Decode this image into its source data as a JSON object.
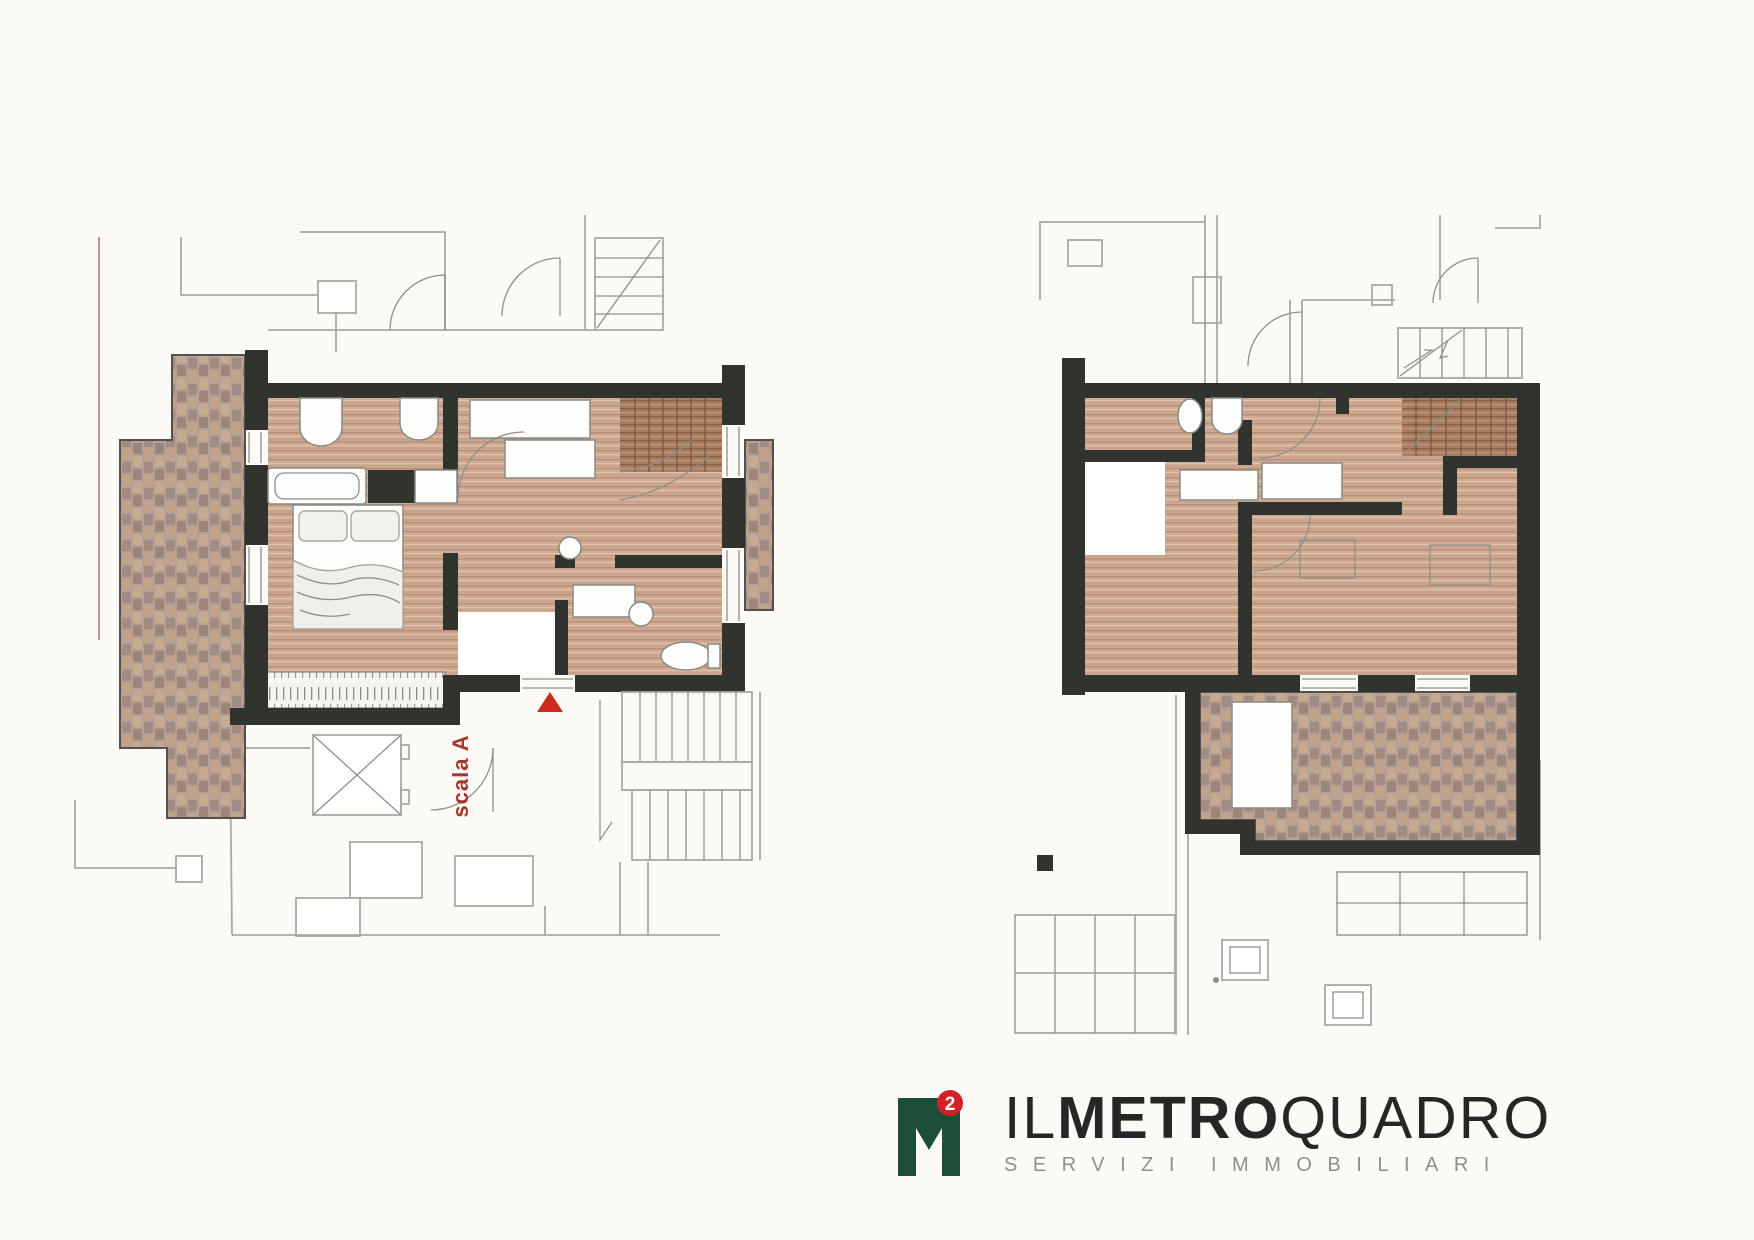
{
  "document": {
    "type": "floor-plan-sheet",
    "background": "#fbfaf6"
  },
  "palette": {
    "wall": "#30332e",
    "wood_light": "#cfab93",
    "wood_dark": "#a97f63",
    "herringbone_base": "#b4a096",
    "outline_gray": "#a9a9a3",
    "boundary_pink": "#c38f8f",
    "accent_red": "#cf2a1e",
    "label_red": "#a8352c"
  },
  "plans": [
    {
      "id": "left",
      "name": "lower-floor-plan",
      "stair_label": "scala A",
      "entrance_marker": "red-triangle-icon"
    },
    {
      "id": "right",
      "name": "upper-floor-plan"
    }
  ],
  "labels": {
    "stair": "scala A"
  },
  "logo": {
    "monogram": "M",
    "superscript": "2",
    "il": "IL",
    "metro": "METRO",
    "quadro": "QUADRO",
    "tagline": "SERVIZI IMMOBILIARI",
    "green": "#1d4f38",
    "red": "#d32027",
    "text_dark": "#262626",
    "text_gray": "#8f8f8d"
  }
}
